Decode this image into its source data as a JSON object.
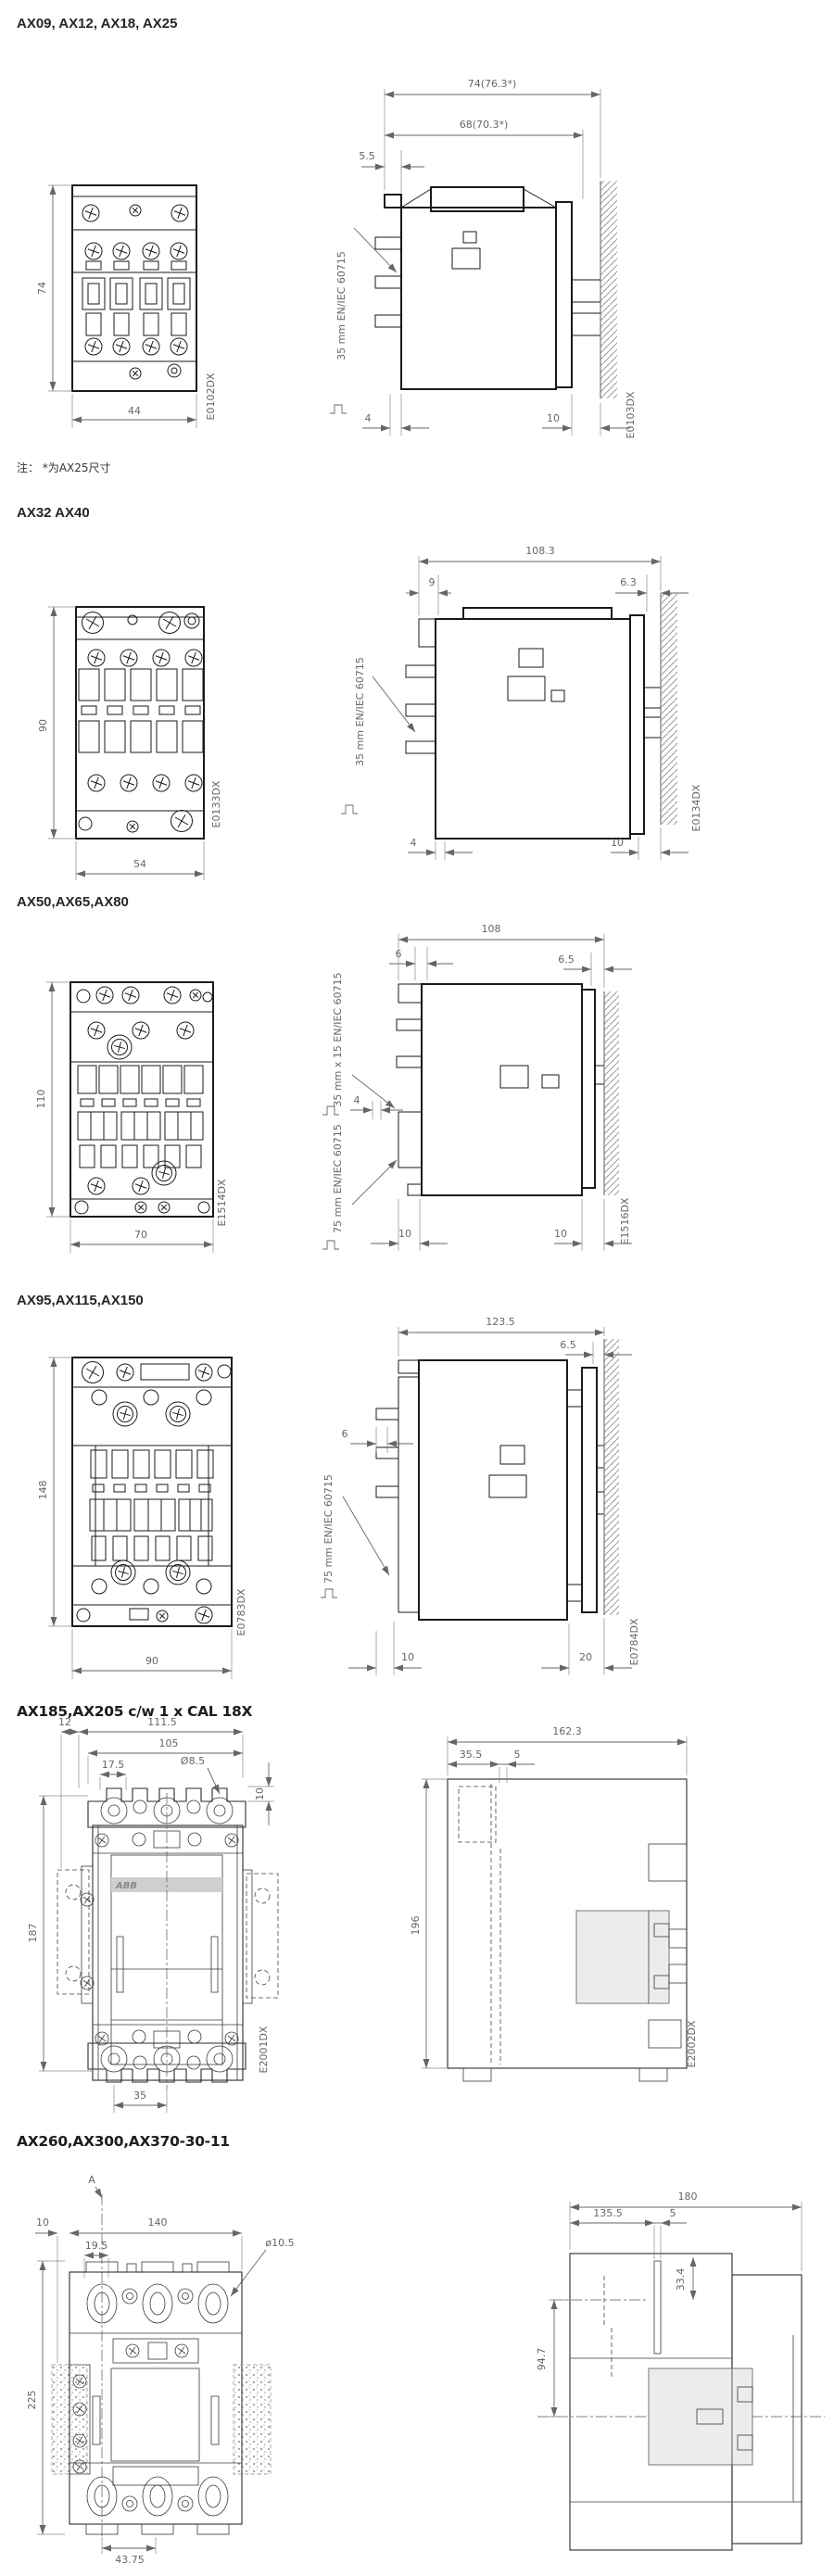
{
  "page": {
    "bg": "#ffffff"
  },
  "sections": [
    {
      "title": "AX09, AX12, AX18, AX25",
      "note": "注： *为AX25尺寸",
      "front": {
        "h": "74",
        "w": "44",
        "code": "E0102DX"
      },
      "side": {
        "total": "74(76.3*)",
        "inner": "68(70.3*)",
        "top": "5.5",
        "rail": "35 mm EN/IEC 60715",
        "b1": "4",
        "b2": "10",
        "code": "E0103DX"
      }
    },
    {
      "title": "AX32 AX40",
      "front": {
        "h": "90",
        "w": "54",
        "code": "E0133DX"
      },
      "side": {
        "total": "108.3",
        "d1": "9",
        "d2": "6.3",
        "rail": "35 mm EN/IEC 60715",
        "b1": "4",
        "b2": "10",
        "code": "E0134DX"
      }
    },
    {
      "title": "AX50,AX65,AX80",
      "front": {
        "h": "110",
        "w": "70",
        "code": "E1514DX"
      },
      "side": {
        "total": "108",
        "d1": "6",
        "d2": "6.5",
        "rail_top": "35 mm x 15 EN/IEC 60715",
        "mid": "4",
        "rail_bottom": "75 mm EN/IEC 60715",
        "b1": "10",
        "b2": "10",
        "code": "E1516DX"
      }
    },
    {
      "title": "AX95,AX115,AX150",
      "front": {
        "h": "148",
        "w": "90",
        "code": "E0783DX"
      },
      "side": {
        "total": "123.5",
        "d1": "6",
        "d2": "6.5",
        "rail": "75 mm EN/IEC 60715",
        "b1": "10",
        "b2": "20",
        "code": "E0784DX"
      }
    },
    {
      "title": "AX185,AX205 c/w 1 x CAL 18X",
      "front": {
        "d12": "12",
        "d111": "111.5",
        "d105": "105",
        "d175": "17.5",
        "dia": "Ø8.5",
        "d10": "10",
        "h": "187",
        "d35": "35",
        "brand": "ABB",
        "code": "E2001DX"
      },
      "side": {
        "total": "162.3",
        "d355": "35.5",
        "d5": "5",
        "h": "196",
        "code": "E2002DX"
      }
    },
    {
      "title": "AX260,AX300,AX370-30-11",
      "front": {
        "marker": "A",
        "d10": "10",
        "d140": "140",
        "d195": "19.5",
        "dia": "ø10.5",
        "h": "225",
        "d4375": "43.75"
      },
      "side": {
        "total": "180",
        "d1355": "135.5",
        "d5": "5",
        "d947": "94.7",
        "d334": "33.4"
      }
    }
  ]
}
